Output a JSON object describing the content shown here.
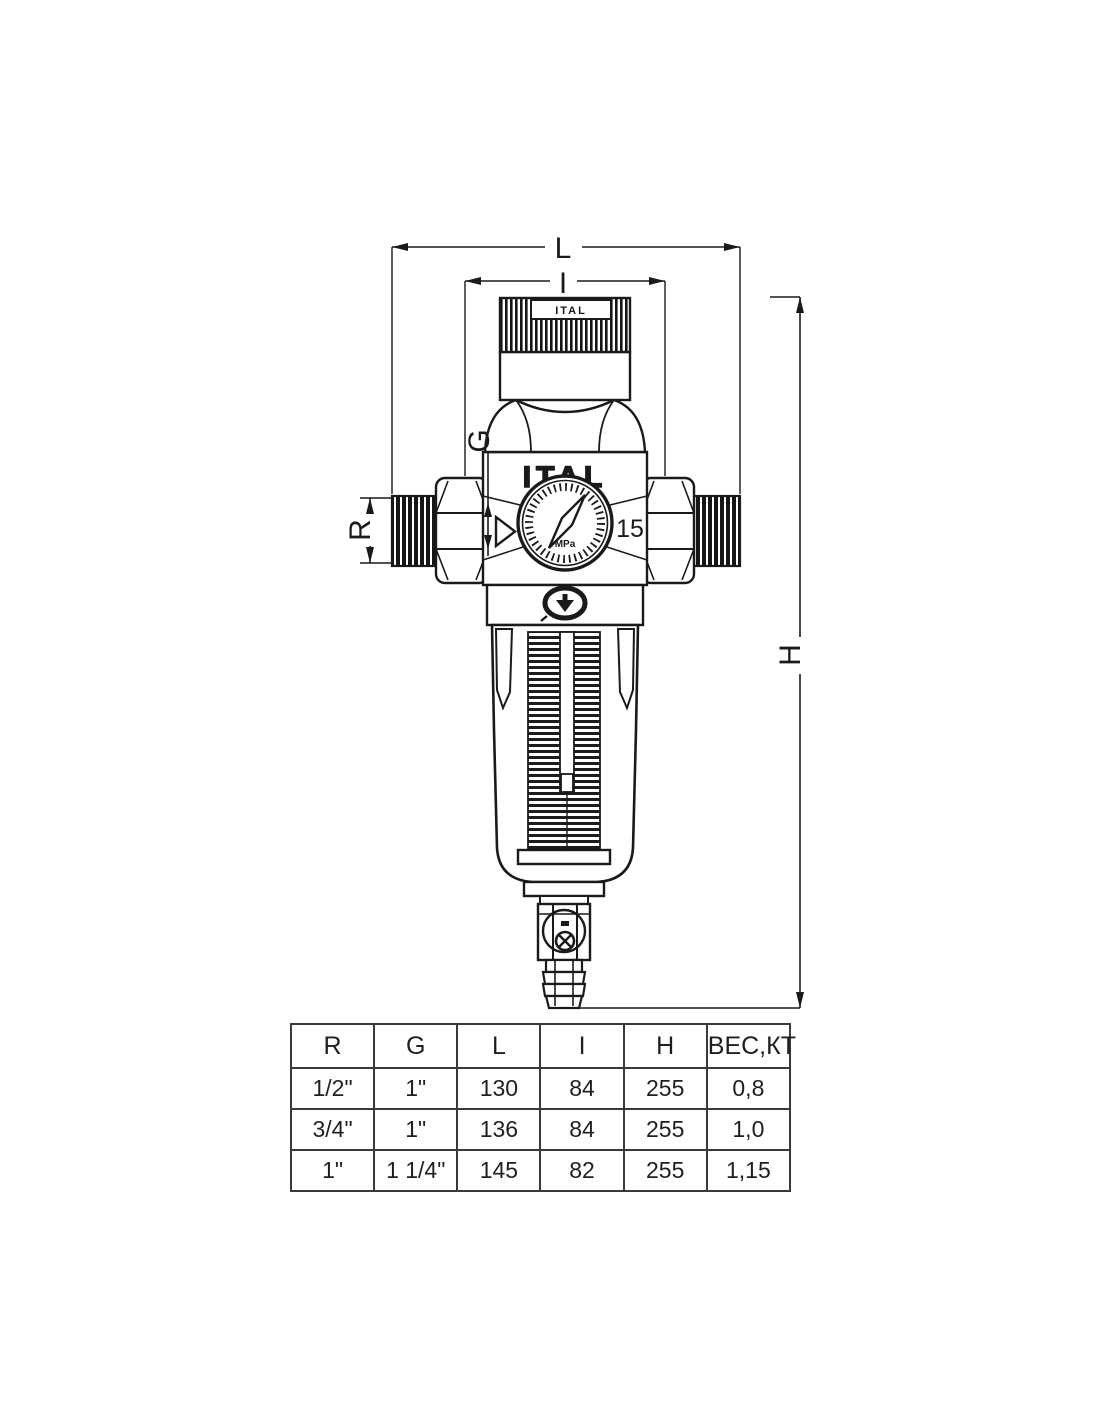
{
  "drawing": {
    "brand_logo": "ITAL",
    "cap_plate_label": "ITAL",
    "gauge": {
      "unit": "MPa",
      "side_label": "15"
    },
    "dims": {
      "L": "L",
      "I": "I",
      "G": "G",
      "R": "R",
      "H": "H"
    }
  },
  "table": {
    "headers": [
      "R",
      "G",
      "L",
      "I",
      "H",
      "ВЕС,КТ"
    ],
    "rows": [
      [
        "1/2\"",
        "1\"",
        "130",
        "84",
        "255",
        "0,8"
      ],
      [
        "3/4\"",
        "1\"",
        "136",
        "84",
        "255",
        "1,0"
      ],
      [
        "1\"",
        "1 1/4\"",
        "145",
        "82",
        "255",
        "1,15"
      ]
    ]
  }
}
